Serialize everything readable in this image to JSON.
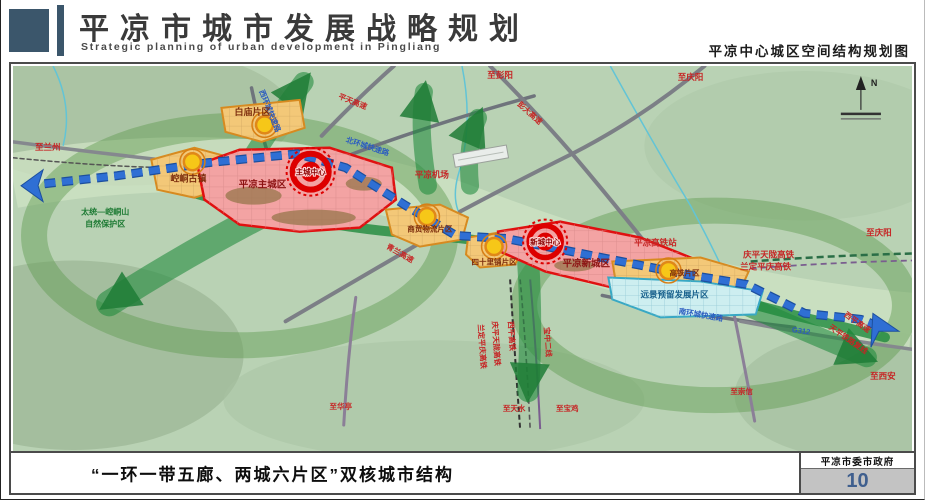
{
  "header": {
    "title": "平凉市城市发展战略规划",
    "subtitle": "Strategic planning of urban development in Pingliang",
    "map_title": "平凉中心城区空间结构规划图"
  },
  "footer": {
    "caption": "“一环一带五廊、两城六片区”双核城市结构",
    "organization": "平凉市委市政府",
    "page_number": "10"
  },
  "map": {
    "compass_label": "N",
    "cores": {
      "main": "主城中心",
      "new": "新城中心"
    },
    "districts": {
      "baimiao": "白庙片区",
      "kongtong": "崆峒古镇",
      "main_city": "平凉主城区",
      "trade_logistics": "商贸物流片区",
      "sishilipu": "四十里铺片区",
      "new_city": "平凉新城区",
      "hsr": "高铁片区",
      "reserved": "远景预留发展片区",
      "nature_reserve_line1": "太统—崆峒山",
      "nature_reserve_line2": "自然保护区"
    },
    "stations": {
      "airport": "平凉机场",
      "hsr_station": "平凉高铁站"
    },
    "roads": {
      "west_ring": "西环城快速路",
      "north_ring": "北环城快速路",
      "south_ring": "南环城快速路",
      "pingtian_expwy": "平天高速",
      "pengda_expwy": "彭大高速",
      "qinglan_expwy": "青兰高速",
      "g312": "G312",
      "xiping_expwy": "西平高速",
      "tianping_railway": "天平铁路复线"
    },
    "railways": {
      "qingping_tianlong_hsr": "庆平天陇高铁",
      "landing_pingqing_hsr": "兰定平庆高铁",
      "qingping_tianlong_hsr_v": "庆平天陇高铁",
      "landing_pingqing_hsr_v": "兰定平庆高铁",
      "xiping_hsr_v": "西平高铁",
      "baozhong_second_line": "宝中二线"
    },
    "directions": {
      "to_lanzhou": "至兰州",
      "to_pengyang": "至彭阳",
      "to_qingyang_top": "至庆阳",
      "to_qingyang_right": "至庆阳",
      "to_xian": "至西安",
      "to_chongxin": "至崇信",
      "to_huating": "至华亭",
      "to_tianshui": "至天水",
      "to_baoji": "至宝鸡"
    }
  }
}
